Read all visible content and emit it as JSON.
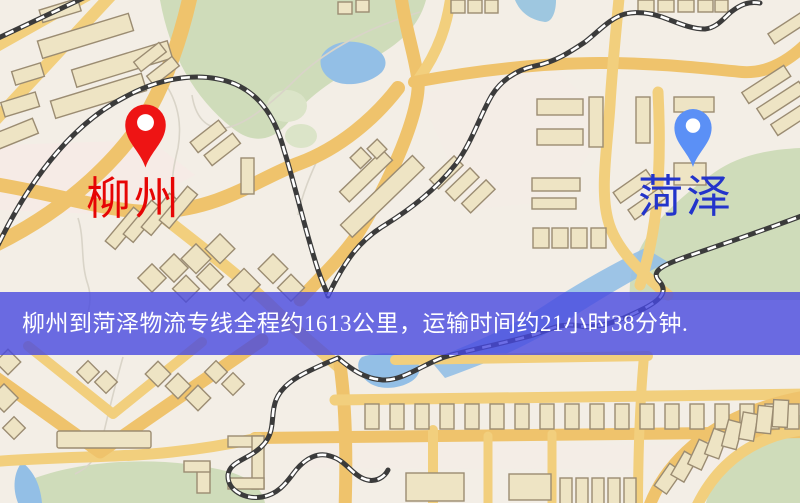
{
  "map": {
    "markers": {
      "origin": {
        "label": "柳州",
        "pin_color": "#ee1414",
        "label_color": "#e60505"
      },
      "destination": {
        "label": "菏泽",
        "pin_color": "#5b90f6",
        "label_color": "#2334cb"
      }
    },
    "route_banner": {
      "text": "柳州到菏泽物流专线全程约1613公里，运输时间约21小时38分钟.",
      "distance_km": "1613",
      "duration": "21小时38分钟",
      "background_color": "rgba(71,72,224,0.8)",
      "text_color": "#ffffff"
    },
    "palette": {
      "background": "#f3eee6",
      "road": "#f2cf7d",
      "park": "#cfdcba",
      "water": "#93bfe6",
      "building": "#eee4c4",
      "railway": "#3b3b3b"
    }
  }
}
